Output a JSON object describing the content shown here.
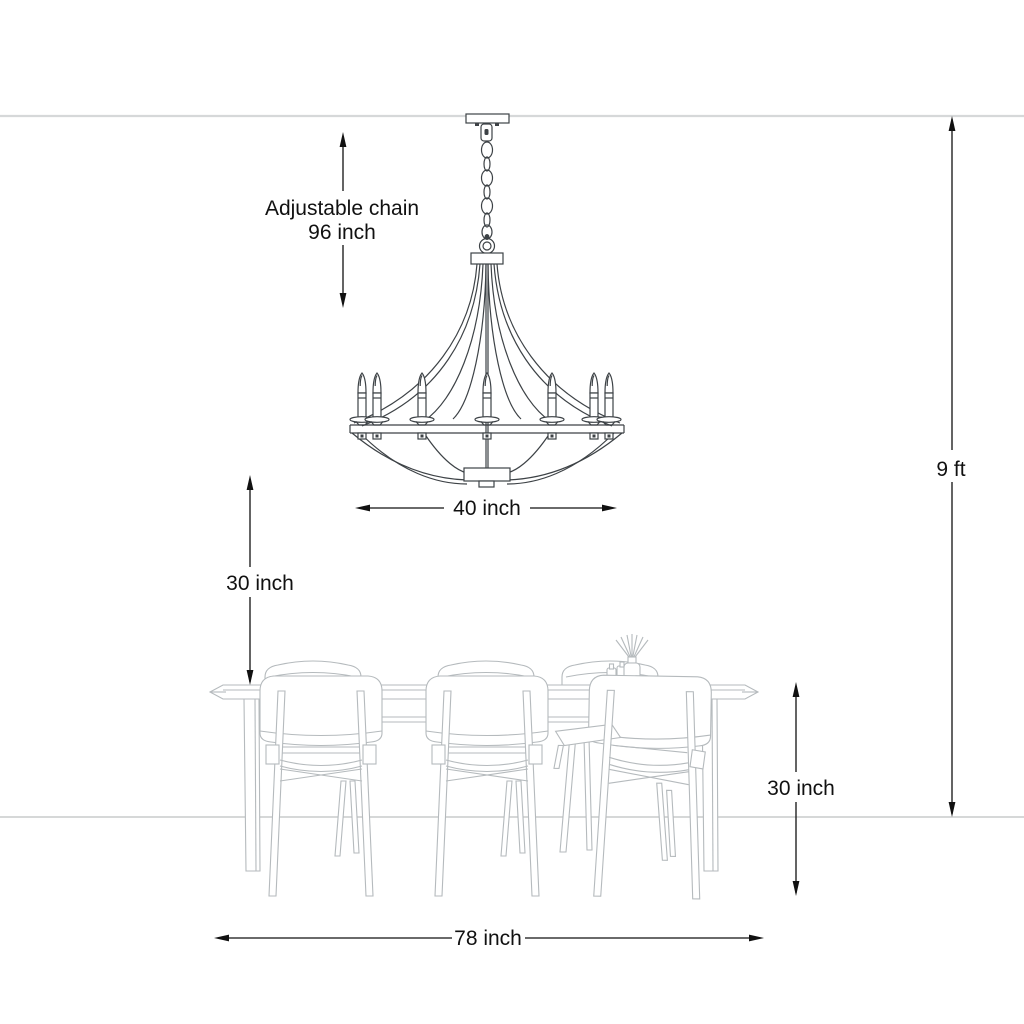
{
  "annotations": {
    "adjustable_chain": {
      "line1": "Adjustable chain",
      "line2": "96 inch"
    },
    "chandelier_width": {
      "label": "40 inch"
    },
    "ceiling_height": {
      "label": "9 ft"
    },
    "hanging_clearance": {
      "label": "30 inch"
    },
    "table_height": {
      "label": "30 inch"
    },
    "table_width": {
      "label": "78 inch"
    }
  },
  "colors": {
    "dim": "#111111",
    "furn": "#b5babd",
    "chand": "#3d4246",
    "ceil": "#d6d8d9",
    "floor": "#c9cbcc",
    "bg": "#ffffff"
  }
}
